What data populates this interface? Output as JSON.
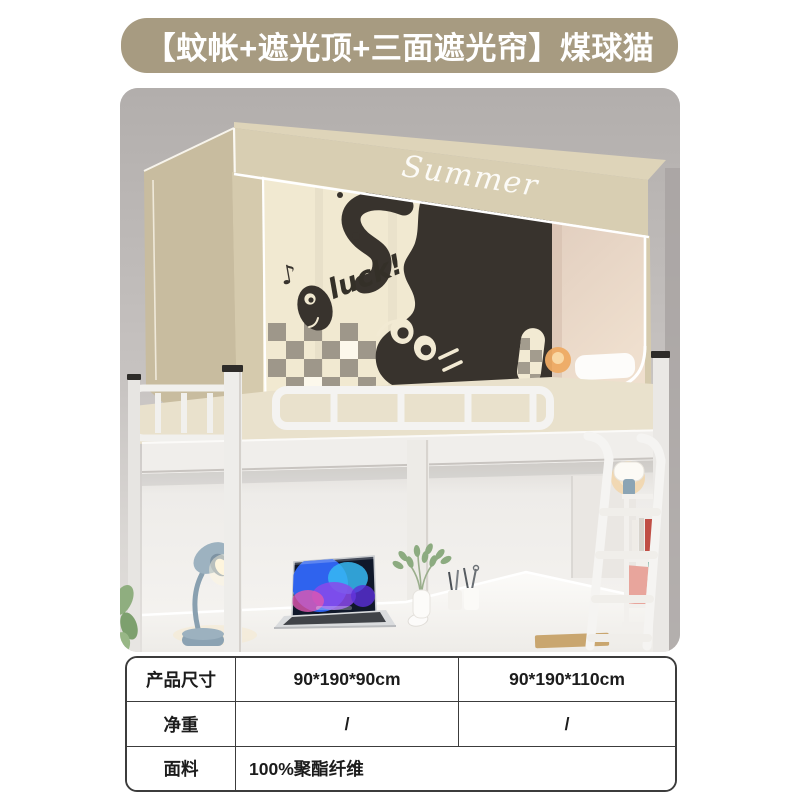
{
  "banner": {
    "title": "【蚊帐+遮光顶+三面遮光帘】煤球猫",
    "bg_color": "#a79b81",
    "text_color": "#ffffff"
  },
  "product_image": {
    "description": "Loft dorm bed with beige blackout canopy mosquito net printed with a black coal-ball cat, desk scene underneath",
    "canopy_text": "Summer",
    "curtain_text": "luck!",
    "music_note": "♪",
    "colors": {
      "canopy_beige": "#d9cfb3",
      "canopy_side": "#c8bc9f",
      "curtain_cream": "#f1e9d1",
      "cat_black": "#38332d",
      "wall_gray": "#b5b1ae",
      "desk_lamp_blue": "#8ea4b2",
      "frame_white": "#f2f1ef"
    }
  },
  "spec_table": {
    "rows": [
      {
        "label": "产品尺寸",
        "value1": "90*190*90cm",
        "value2": "90*190*110cm"
      },
      {
        "label": "净重",
        "value1": "/",
        "value2": "/"
      },
      {
        "label": "面料",
        "value1": "100%聚酯纤维",
        "value2": ""
      }
    ]
  }
}
